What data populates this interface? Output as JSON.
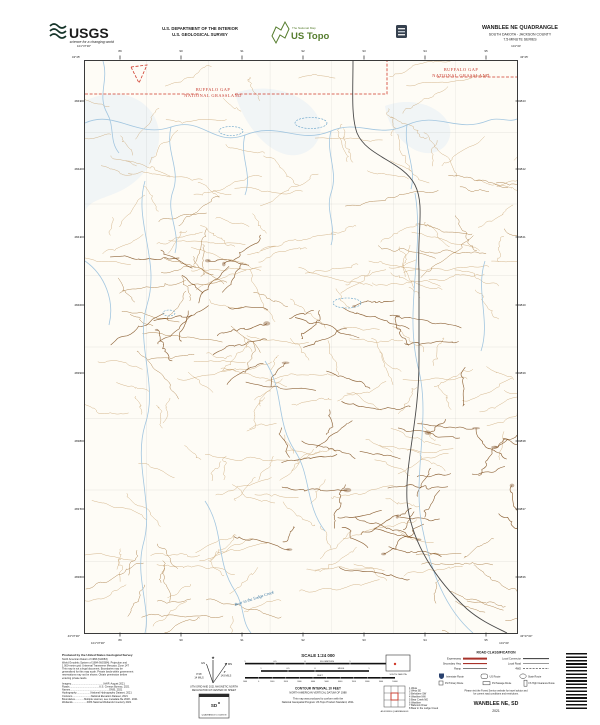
{
  "header": {
    "usgs": {
      "name": "USGS",
      "tagline": "science for a changing world"
    },
    "dept_line1": "U.S. DEPARTMENT OF THE INTERIOR",
    "dept_line2": "U.S. GEOLOGICAL SURVEY",
    "ustopo": {
      "brand_small": "The National Map",
      "brand_large": "US Topo"
    },
    "quad_title": "WANBLEE NE QUADRANGLE",
    "quad_subtitle": "SOUTH DAKOTA - JACKSON COUNTY",
    "quad_series": "7.5-MINUTE SERIES"
  },
  "map": {
    "labels": {
      "grassland_1": "BUFFALO GAP",
      "grassland_2": "NATIONAL GRASSLAND",
      "creek": "Bear in the Lodge Creek"
    },
    "grid": {
      "top": [
        "89",
        "90",
        "91",
        "92",
        "93",
        "94",
        "95"
      ],
      "left": [
        "4843",
        "4842",
        "4841",
        "4840",
        "4839",
        "4838",
        "4837",
        "4836"
      ],
      "bottom": [
        "89",
        "90",
        "91",
        "92",
        "93",
        "94",
        "95"
      ],
      "corners": {
        "tl_lon": "101°37′30″",
        "tl_lat": "43°45′",
        "tr_lon": "101°30′",
        "tr_lat": "43°45′",
        "bl_lat": "43°37′30″",
        "bl_lon": "101°37′30″",
        "br_lat": "43°37′30″",
        "br_lon": "101°30′"
      }
    }
  },
  "footer": {
    "credits": {
      "title": "Produced by the United States Geological Survey",
      "lines": [
        "North American Datum of 1983 (NAD83)",
        "World Geodetic System of 1984 (WGS84). Projection and",
        "1 000-meter grid: Universal Transverse Mercator, Zone 14T",
        "This map is not a legal document. Boundaries may be",
        "generalized for this map scale. Private lands within government",
        "reservations may not be shown. Obtain permission before",
        "entering private lands."
      ],
      "sources": [
        "Imagery..............................................NAIP, August 2021",
        "Roads..........................................U.S. Census Bureau, 2021",
        "Names.......................................................GNIS, 2021",
        "Hydrography....................National Hydrography Dataset, 2021",
        "Contours..........................National Elevation Dataset, 2021",
        "Boundaries.............Multiple sources; see metadata file 2018 - 2021",
        "Wetlands....................FWS National Wetlands Inventory 2021"
      ]
    },
    "declination": {
      "star": "★",
      "gn": "GN",
      "mn": "MN",
      "gn_value": "0°46′",
      "gn_mils": "14 MILS",
      "mn_value": "8°",
      "mn_mils": "143 MILS",
      "caption_1": "UTM GRID AND 2021 MAGNETIC NORTH",
      "caption_2": "DECLINATION AT CENTER OF SHEET"
    },
    "location_inset": {
      "abbr": "SD",
      "caption": "QUADRANGLE LOCATION"
    },
    "state_map": {
      "caption": "SOUTH DAKOTA"
    },
    "adjoining": {
      "caption": "ADJOINING QUADRANGLES",
      "items": [
        "1 Weta",
        "2 Weta SE",
        "3 Belvidere SW",
        "4 Wanblee NW",
        "5 Bear Creek NE",
        "6 Wanblee",
        "7 Babcock Draw",
        "8 Bear in the Lodge Creek"
      ]
    },
    "scale": {
      "title": "SCALE 1:24 000",
      "km_labels": [
        "1",
        "0.5",
        "0",
        "1",
        "2"
      ],
      "km_unit": "KILOMETERS",
      "mi_labels": [
        "1",
        "0.5",
        "0",
        "1"
      ],
      "mi_unit": "MILES",
      "ft_labels": [
        "1000",
        "0",
        "1000",
        "2000",
        "3000",
        "4000",
        "5000",
        "6000",
        "7000",
        "8000",
        "9000",
        "10000"
      ],
      "ft_unit": "FEET",
      "contour": "CONTOUR INTERVAL 10 FEET",
      "vdatum": "NORTH AMERICAN VERTICAL DATUM OF 1988",
      "conform_1": "This map was produced to conform with the",
      "conform_2": "National Geospatial Program US Topo Product Standard, 2011."
    },
    "roads": {
      "title": "ROAD CLASSIFICATION",
      "col1": [
        "Expressway",
        "Secondary Hwy",
        "Ramp"
      ],
      "col2": [
        "Local Connector",
        "Local Road",
        "4WD"
      ],
      "shields": [
        "Interstate Route",
        "US Route",
        "State Route"
      ],
      "fs": [
        "FS Primary Route",
        "FS Passage Route",
        "FS High Clearance Route"
      ],
      "note_1": "Please visit the Forest Service website for travel advice and",
      "note_2": "for current road conditions and restrictions.",
      "map_name": "WANBLEE NE, SD",
      "year": "2021"
    },
    "colors": {
      "grassland_red": "#c63b2f",
      "topo_green": "#567d2e",
      "contour_brown": "#a97c45",
      "water_blue": "#9dc3de"
    }
  }
}
